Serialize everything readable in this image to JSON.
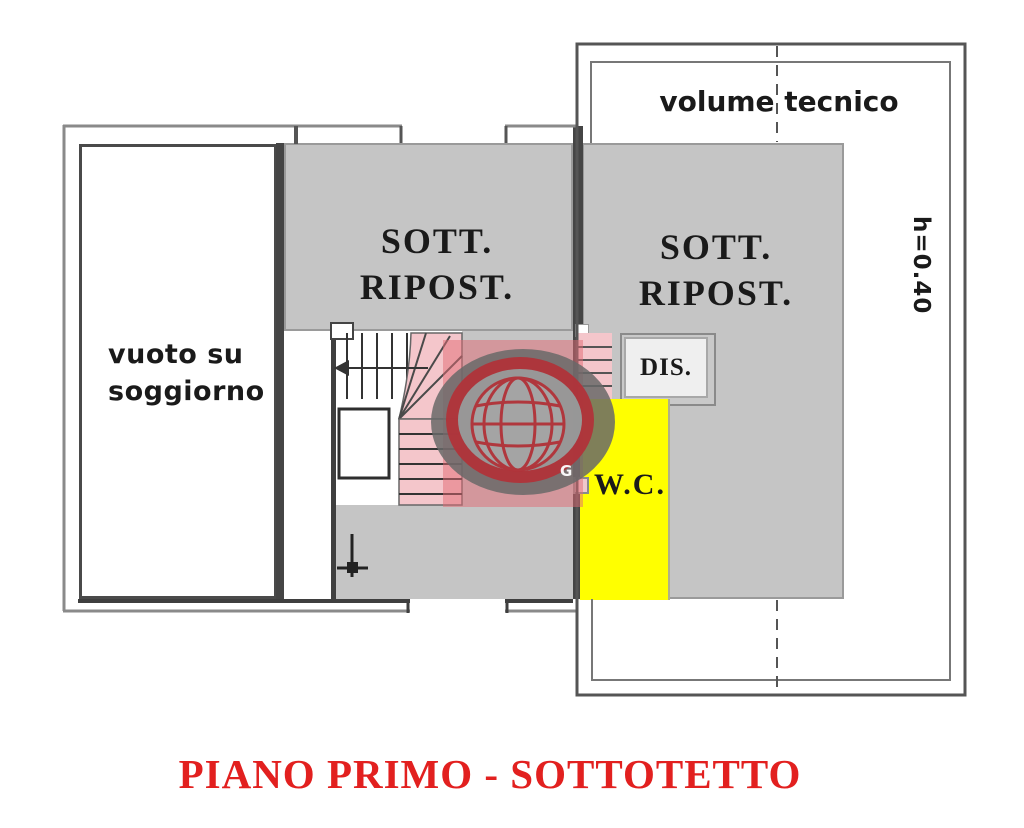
{
  "plan": {
    "title": "PIANO PRIMO - SOTTOTETTO",
    "rooms": {
      "sott_left": {
        "line1": "SOTT.",
        "line2": "RIPOST."
      },
      "sott_right": {
        "line1": "SOTT.",
        "line2": "RIPOST."
      },
      "vuoto": {
        "line1": "vuoto su",
        "line2": "soggiorno"
      },
      "volume_tecnico": "volume tecnico",
      "dis": "DIS.",
      "wc": "W.C."
    },
    "height_annotation": "h=0.40",
    "watermark_letter": "G"
  },
  "colors": {
    "room-gray": "#c5c5c5",
    "room-light": "#efefef",
    "wc-yellow": "#ffff00",
    "stair-pink": "#f4c6cb",
    "wall-dark": "#454545",
    "line-mid": "#8a8a8a",
    "title-red": "#e2201f",
    "wm-red": "#b23239",
    "wm-band": "rgba(226,106,116,0.5)",
    "wm-gray": "rgba(104,104,104,0.85)"
  }
}
